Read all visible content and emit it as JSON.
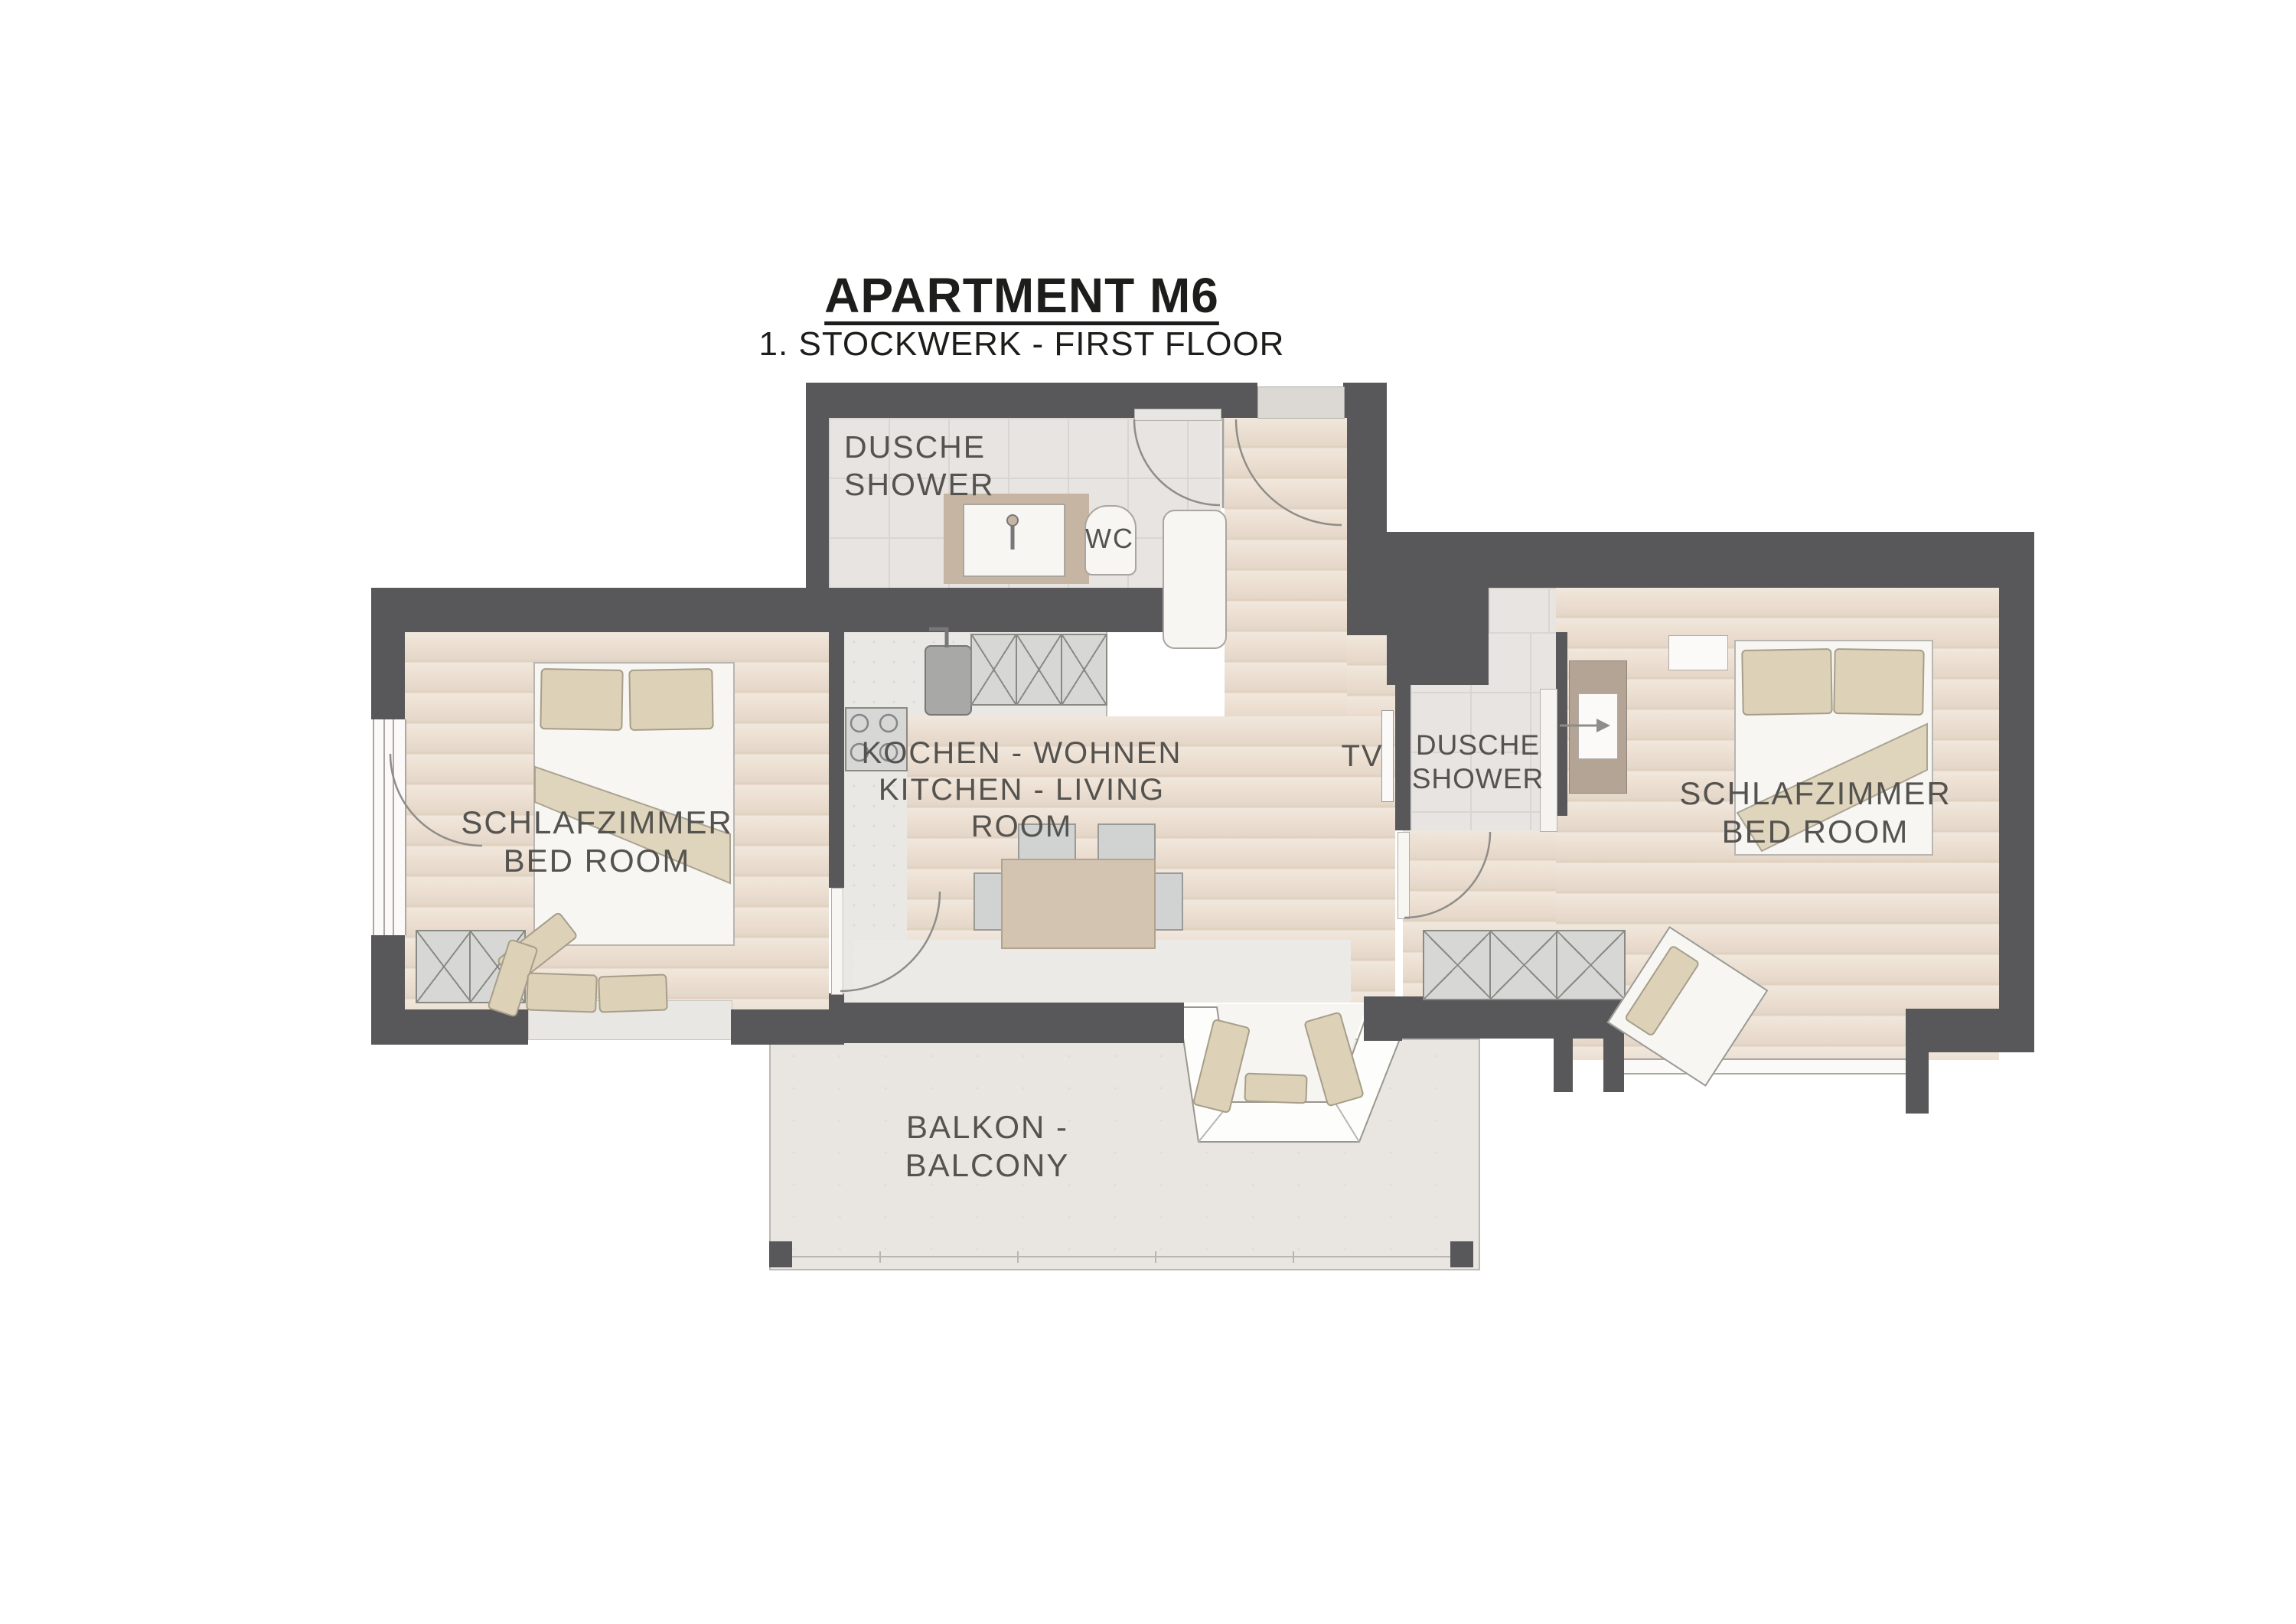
{
  "header": {
    "title": "APARTMENT M6",
    "subtitle": "1. STOCKWERK - FIRST FLOOR"
  },
  "rooms": {
    "bathroom_top": {
      "label": "DUSCHE\nSHOWER"
    },
    "wc": {
      "label": "WC"
    },
    "kitchen_living": {
      "label": "KOCHEN - WOHNEN\nKITCHEN - LIVING ROOM"
    },
    "tv": {
      "label": "TV"
    },
    "bedroom_left": {
      "label": "SCHLAFZIMMER\nBED ROOM"
    },
    "shower_right": {
      "label": "DUSCHE\nSHOWER"
    },
    "bedroom_right": {
      "label": "SCHLAFZIMMER\nBED ROOM"
    },
    "balcony": {
      "label": "BALKON -\nBALCONY"
    }
  },
  "colors": {
    "wall": "#58585a",
    "wood_floor": "#ecdfd1",
    "tile_floor": "#e7e4e1",
    "balcony_floor": "#e9e6e1",
    "furniture_tan": "#ddd2b8",
    "cabinet_gray": "#d7d7d5",
    "fixture_white": "#f7f6f3",
    "text": "#55534f",
    "title_text": "#1d1d1b"
  }
}
